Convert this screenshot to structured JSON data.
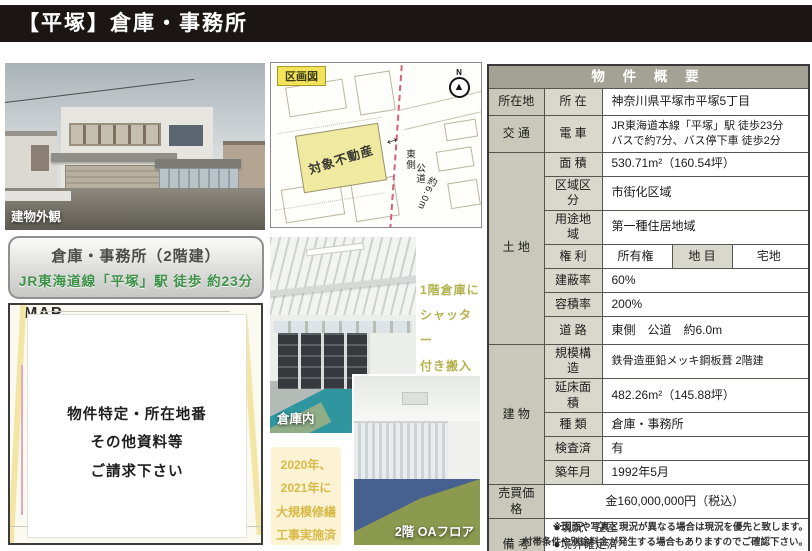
{
  "page": {
    "title_bar": "【平塚】倉庫・事務所"
  },
  "colors": {
    "title_bar_bg": "#1b1613",
    "table_header_bg": "#a3a294",
    "accent_green": "#3d9147",
    "note_yellow_text": "#d8ba48",
    "subject_parcel_fill": "#f0eaa0",
    "teal_floor": "#2f96a0"
  },
  "left": {
    "exterior_photo_label": "建物外観",
    "summary_box": {
      "line1": "倉庫・事務所（2階建）",
      "line2": "JR東海道線「平塚」駅 徒歩 約23分"
    },
    "map": {
      "watermark": "MAP",
      "overlay": {
        "line1": "物件特定・所在地番",
        "line2": "その他資料等",
        "line3": "ご請求下さい"
      }
    }
  },
  "center": {
    "plot_map": {
      "tag": "区画図",
      "parcel": "対象不動産",
      "compass_n": "N",
      "compass_needle": "▲",
      "arrow": "↔",
      "road_label_1": "東側",
      "road_label_2": "公道",
      "road_label_3": "約6.0m"
    },
    "warehouse_photo_label": "倉庫内",
    "office_photo_label": "2階 OAフロア",
    "shutter_note": {
      "line1": "1階倉庫に",
      "line2": "シャッター",
      "line3": "付き搬入口"
    },
    "renovation_note": {
      "line1": "2020年、",
      "line2": "2021年に",
      "line3": "大規模修繕",
      "line4": "工事実施済"
    }
  },
  "table": {
    "title": "物 件 概 要",
    "location": {
      "cat": "所在地",
      "label": "所 在",
      "value": "神奈川県平塚市平塚5丁目"
    },
    "access": {
      "cat": "交 通",
      "label": "電 車",
      "value_line1": "JR東海道本線「平塚」駅 徒歩23分",
      "value_line2": "バスで約7分、バス停下車 徒歩2分"
    },
    "land": {
      "cat": "土 地",
      "area": {
        "label": "面 積",
        "value": "530.71m²（160.54坪）"
      },
      "zoning": {
        "label": "区域区分",
        "value": "市街化区域"
      },
      "use_district": {
        "label": "用途地域",
        "value": "第一種住居地域"
      },
      "rights": {
        "label": "権 利",
        "value": "所有権",
        "label2": "地 目",
        "value2": "宅地"
      },
      "bcr": {
        "label": "建蔽率",
        "value": "60%"
      },
      "far": {
        "label": "容積率",
        "value": "200%"
      },
      "road": {
        "label": "道 路",
        "value": "東側　公道　約6.0m"
      }
    },
    "building": {
      "cat": "建 物",
      "structure": {
        "label": "規模構造",
        "value": "鉄骨造亜鉛メッキ鋼板葺 2階建"
      },
      "floor_area": {
        "label": "延床面積",
        "value": "482.26m²（145.88坪）"
      },
      "type": {
        "label": "種 類",
        "value": "倉庫・事務所"
      },
      "inspection": {
        "label": "検査済",
        "value": "有"
      },
      "built": {
        "label": "築年月",
        "value": "1992年5月"
      }
    },
    "price": {
      "cat": "売買価格",
      "value": "金160,000,000円（税込）"
    },
    "remarks": {
      "cat": "備 考",
      "items": [
        "●現況：空室",
        "●境界確定済",
        "●2階事務所はOAフロア、会議室等充実"
      ]
    }
  },
  "footer": {
    "line1": "※図面や写真と現況が異なる場合は現況を優先と致します。",
    "line2": "付帯条件や別途料金が発生する場合もありますのでご確認下さい。"
  }
}
